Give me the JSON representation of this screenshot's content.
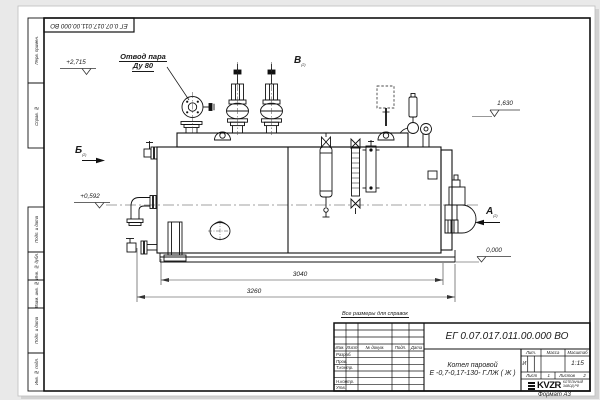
{
  "frame": {
    "corner_stamp": "ЕГ 0.07.017.011.00.000 ВО",
    "format_note": "Формат А3",
    "margin": {
      "perv_primen": "Перв. примен.",
      "sprav_no": "Справ. №",
      "podp_data_1": "Подп. и дата",
      "inv_dubl": "Инв. № дубл.",
      "vzam_inv": "Взам. инв. №",
      "podp_data_2": "Подп. и дата",
      "inv_podl": "Инв. № подл."
    }
  },
  "drawing": {
    "callout": {
      "line1": "Отвод пара",
      "line2": "Ду 80"
    },
    "elevations": {
      "top_left": "+2,715",
      "mid_left": "+0,592",
      "top_right": "1,630",
      "bottom_right": "0,000"
    },
    "views": {
      "a": "А",
      "b": "Б",
      "v": "В",
      "sheet_ref": "(2)"
    },
    "dimensions": {
      "shell_length": "3040",
      "overall_length": "3260"
    }
  },
  "title_block": {
    "note": "Все размеры для справок",
    "designation": "ЕГ 0.07.017.011.00.000  ВО",
    "product": {
      "line1": "Котел паровой",
      "line2": "Е -0,7-0,17-130- Г.ЛЖ ( Ж )"
    },
    "columns": {
      "izm": "Изм.",
      "list": "Лист",
      "doc": "№ докум.",
      "podp": "Подп.",
      "data": "Дата"
    },
    "roles": {
      "razrab": "Разраб.",
      "prov": "Пров.",
      "tkontr": "Т.контр.",
      "nkontr": "Н.контр.",
      "utv": "Утв."
    },
    "props": {
      "lit_header": "Лит.",
      "mass_header": "Масса",
      "scale_header": "Масштаб",
      "lit_value": "И",
      "scale_value": "1:15"
    },
    "sheets": {
      "sheet_label": "Лист",
      "sheet_value": "1",
      "sheets_label": "Листов",
      "sheets_value": "2"
    },
    "company": {
      "name": "KVZR",
      "tagline1": "КОТЕЛЬНЫЙ",
      "tagline2": "ЗАВОД РФ"
    }
  }
}
